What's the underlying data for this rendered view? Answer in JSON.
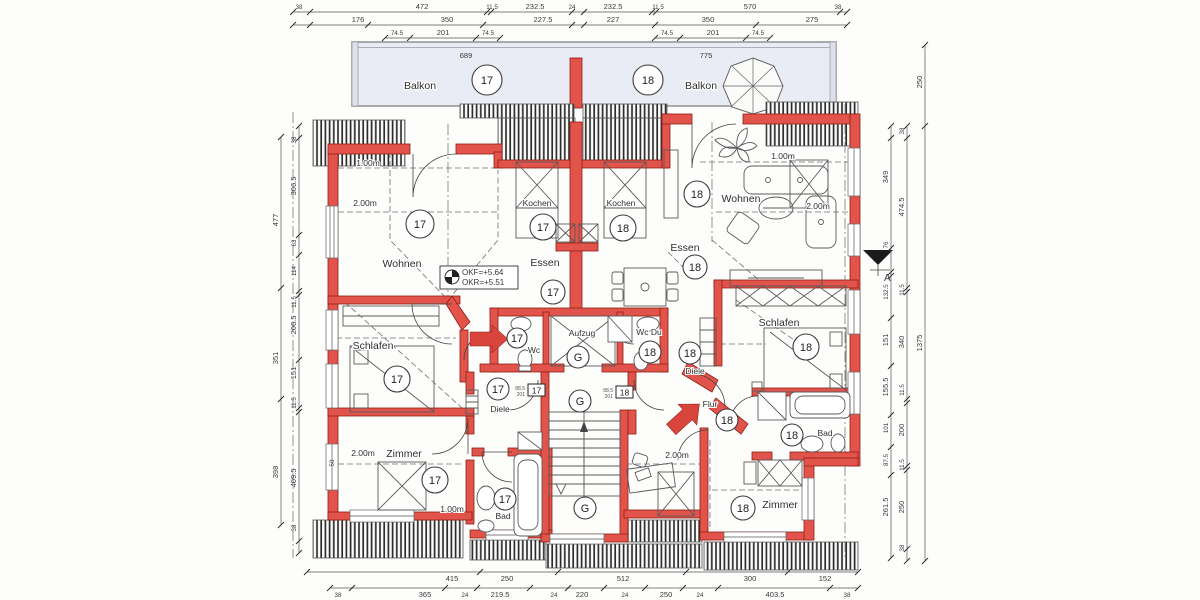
{
  "rooms": {
    "balkon": "Balkon",
    "wohnen": "Wohnen",
    "kochen": "Kochen",
    "essen": "Essen",
    "schlafen": "Schlafen",
    "zimmer": "Zimmer",
    "bad": "Bad",
    "wc": "Wc",
    "wc_du": "Wc Du",
    "diele": "Diele",
    "flur": "Flur",
    "aufzug": "Aufzug"
  },
  "units": {
    "u17": "17",
    "u18": "18",
    "core": "G"
  },
  "levels": {
    "okf": "OKF=+5.64",
    "okr": "OKR=+5.51"
  },
  "heights": {
    "one": "1.00m",
    "two": "2.00m"
  },
  "balcony": {
    "label": "Balkon",
    "width_left": "689",
    "width_right": "775"
  },
  "door_tag": {
    "w": "88,5",
    "h": "201"
  },
  "marker": {
    "section": "A"
  },
  "colors": {
    "wall": "#e2544b",
    "wall_edge": "#8f1d13",
    "balcony_fill": "#e9ecf4",
    "accent": "#d9453c"
  },
  "dims": {
    "top1": [
      "38",
      "472",
      "11.5",
      "232.5",
      "24",
      "232.5",
      "11.5",
      "570",
      "38"
    ],
    "top2": [
      "176",
      "350",
      "227.5",
      "227",
      "350",
      "275"
    ],
    "top3l": [
      "74.5",
      "201",
      "74.5"
    ],
    "top3r": [
      "74.5",
      "201",
      "74.5"
    ],
    "left_outer": [
      "477",
      "351",
      "398"
    ],
    "left_inner": [
      "38",
      "306.5",
      "63",
      "114",
      "11.5",
      "206.5",
      "151",
      "11.5",
      "409.5",
      "38"
    ],
    "right_inner": [
      "349",
      "76",
      "132.5",
      "151",
      "155.5",
      "101",
      "87.5",
      "261.5"
    ],
    "right_mid": [
      "38",
      "474.5",
      "11.5",
      "340",
      "11.5",
      "200",
      "11.5",
      "250",
      "38"
    ],
    "right_outer": [
      "250",
      "1375"
    ],
    "bottom1": [
      "415",
      "250",
      "512",
      "300",
      "152"
    ],
    "bottom2": [
      "38",
      "365",
      "24",
      "219.5",
      "24",
      "220",
      "24",
      "250",
      "24",
      "403.5",
      "38"
    ],
    "extra50": "50"
  }
}
